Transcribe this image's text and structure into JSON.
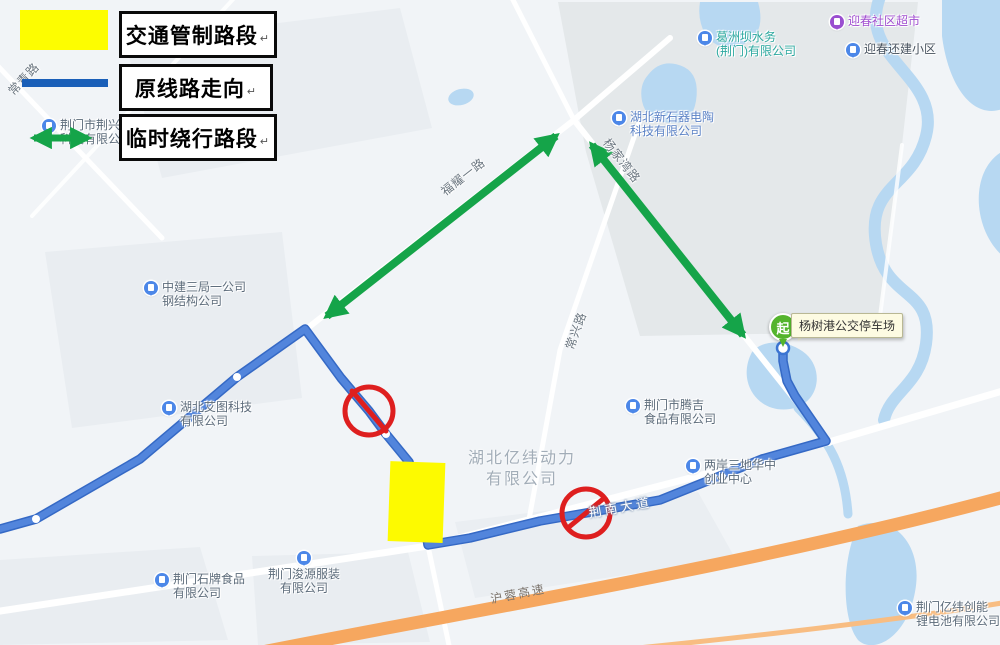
{
  "legend": {
    "return_mark": "↵",
    "items": [
      {
        "label": "交通管制路段",
        "swatch": "yellow-rect"
      },
      {
        "label": "原线路走向",
        "swatch": "blue-line"
      },
      {
        "label": "临时绕行路段",
        "swatch": "green-double-arrow"
      }
    ]
  },
  "map": {
    "road_labels": [
      "常青路",
      "福耀一路",
      "杨家湾路",
      "常兴路",
      "荆南大道",
      "沪蓉高速"
    ],
    "pois": [
      {
        "line1": "荆门市荆兴电",
        "line2": "科技有限公",
        "pin": "building-icon"
      },
      {
        "line1": "葛洲坝水务",
        "line2": "(荆门)有限公司",
        "pin": "building-icon"
      },
      {
        "line1": "迎春社区超市",
        "line2": "",
        "pin": "shop-icon"
      },
      {
        "line1": "迎春还建小区",
        "line2": "",
        "pin": "building-icon"
      },
      {
        "line1": "湖北新石器电陶",
        "line2": "科技有限公司",
        "pin": "building-icon"
      },
      {
        "line1": "中建三局一公司",
        "line2": "钢结构公司",
        "pin": "building-icon"
      },
      {
        "line1": "湖北艾图科技",
        "line2": "有限公司",
        "pin": "building-icon"
      },
      {
        "line1": "荆门市腾吉",
        "line2": "食品有限公司",
        "pin": "building-icon"
      },
      {
        "line1": "两岸三地华中",
        "line2": "创业中心",
        "pin": "building-icon"
      },
      {
        "line1": "荆门石牌食品",
        "line2": "有限公司",
        "pin": "building-icon"
      },
      {
        "line1": "荆门浚源服装",
        "line2": "有限公司",
        "pin": "building-icon"
      },
      {
        "line1": "荆门亿纬创能",
        "line2": "锂电池有限公司",
        "pin": "building-icon"
      }
    ],
    "area_label": {
      "line1": "湖北亿纬动力",
      "line2": "有限公司"
    },
    "start_marker": {
      "glyph": "起",
      "tooltip": "杨树港公交停车场"
    }
  },
  "colors": {
    "control_yellow": "#fdfd00",
    "route_blue": "#5285dc",
    "detour_green": "#15a449",
    "no_entry_red": "#de1f1f",
    "highway_orange": "#f6a75f",
    "water_blue": "#b7d8f2"
  }
}
